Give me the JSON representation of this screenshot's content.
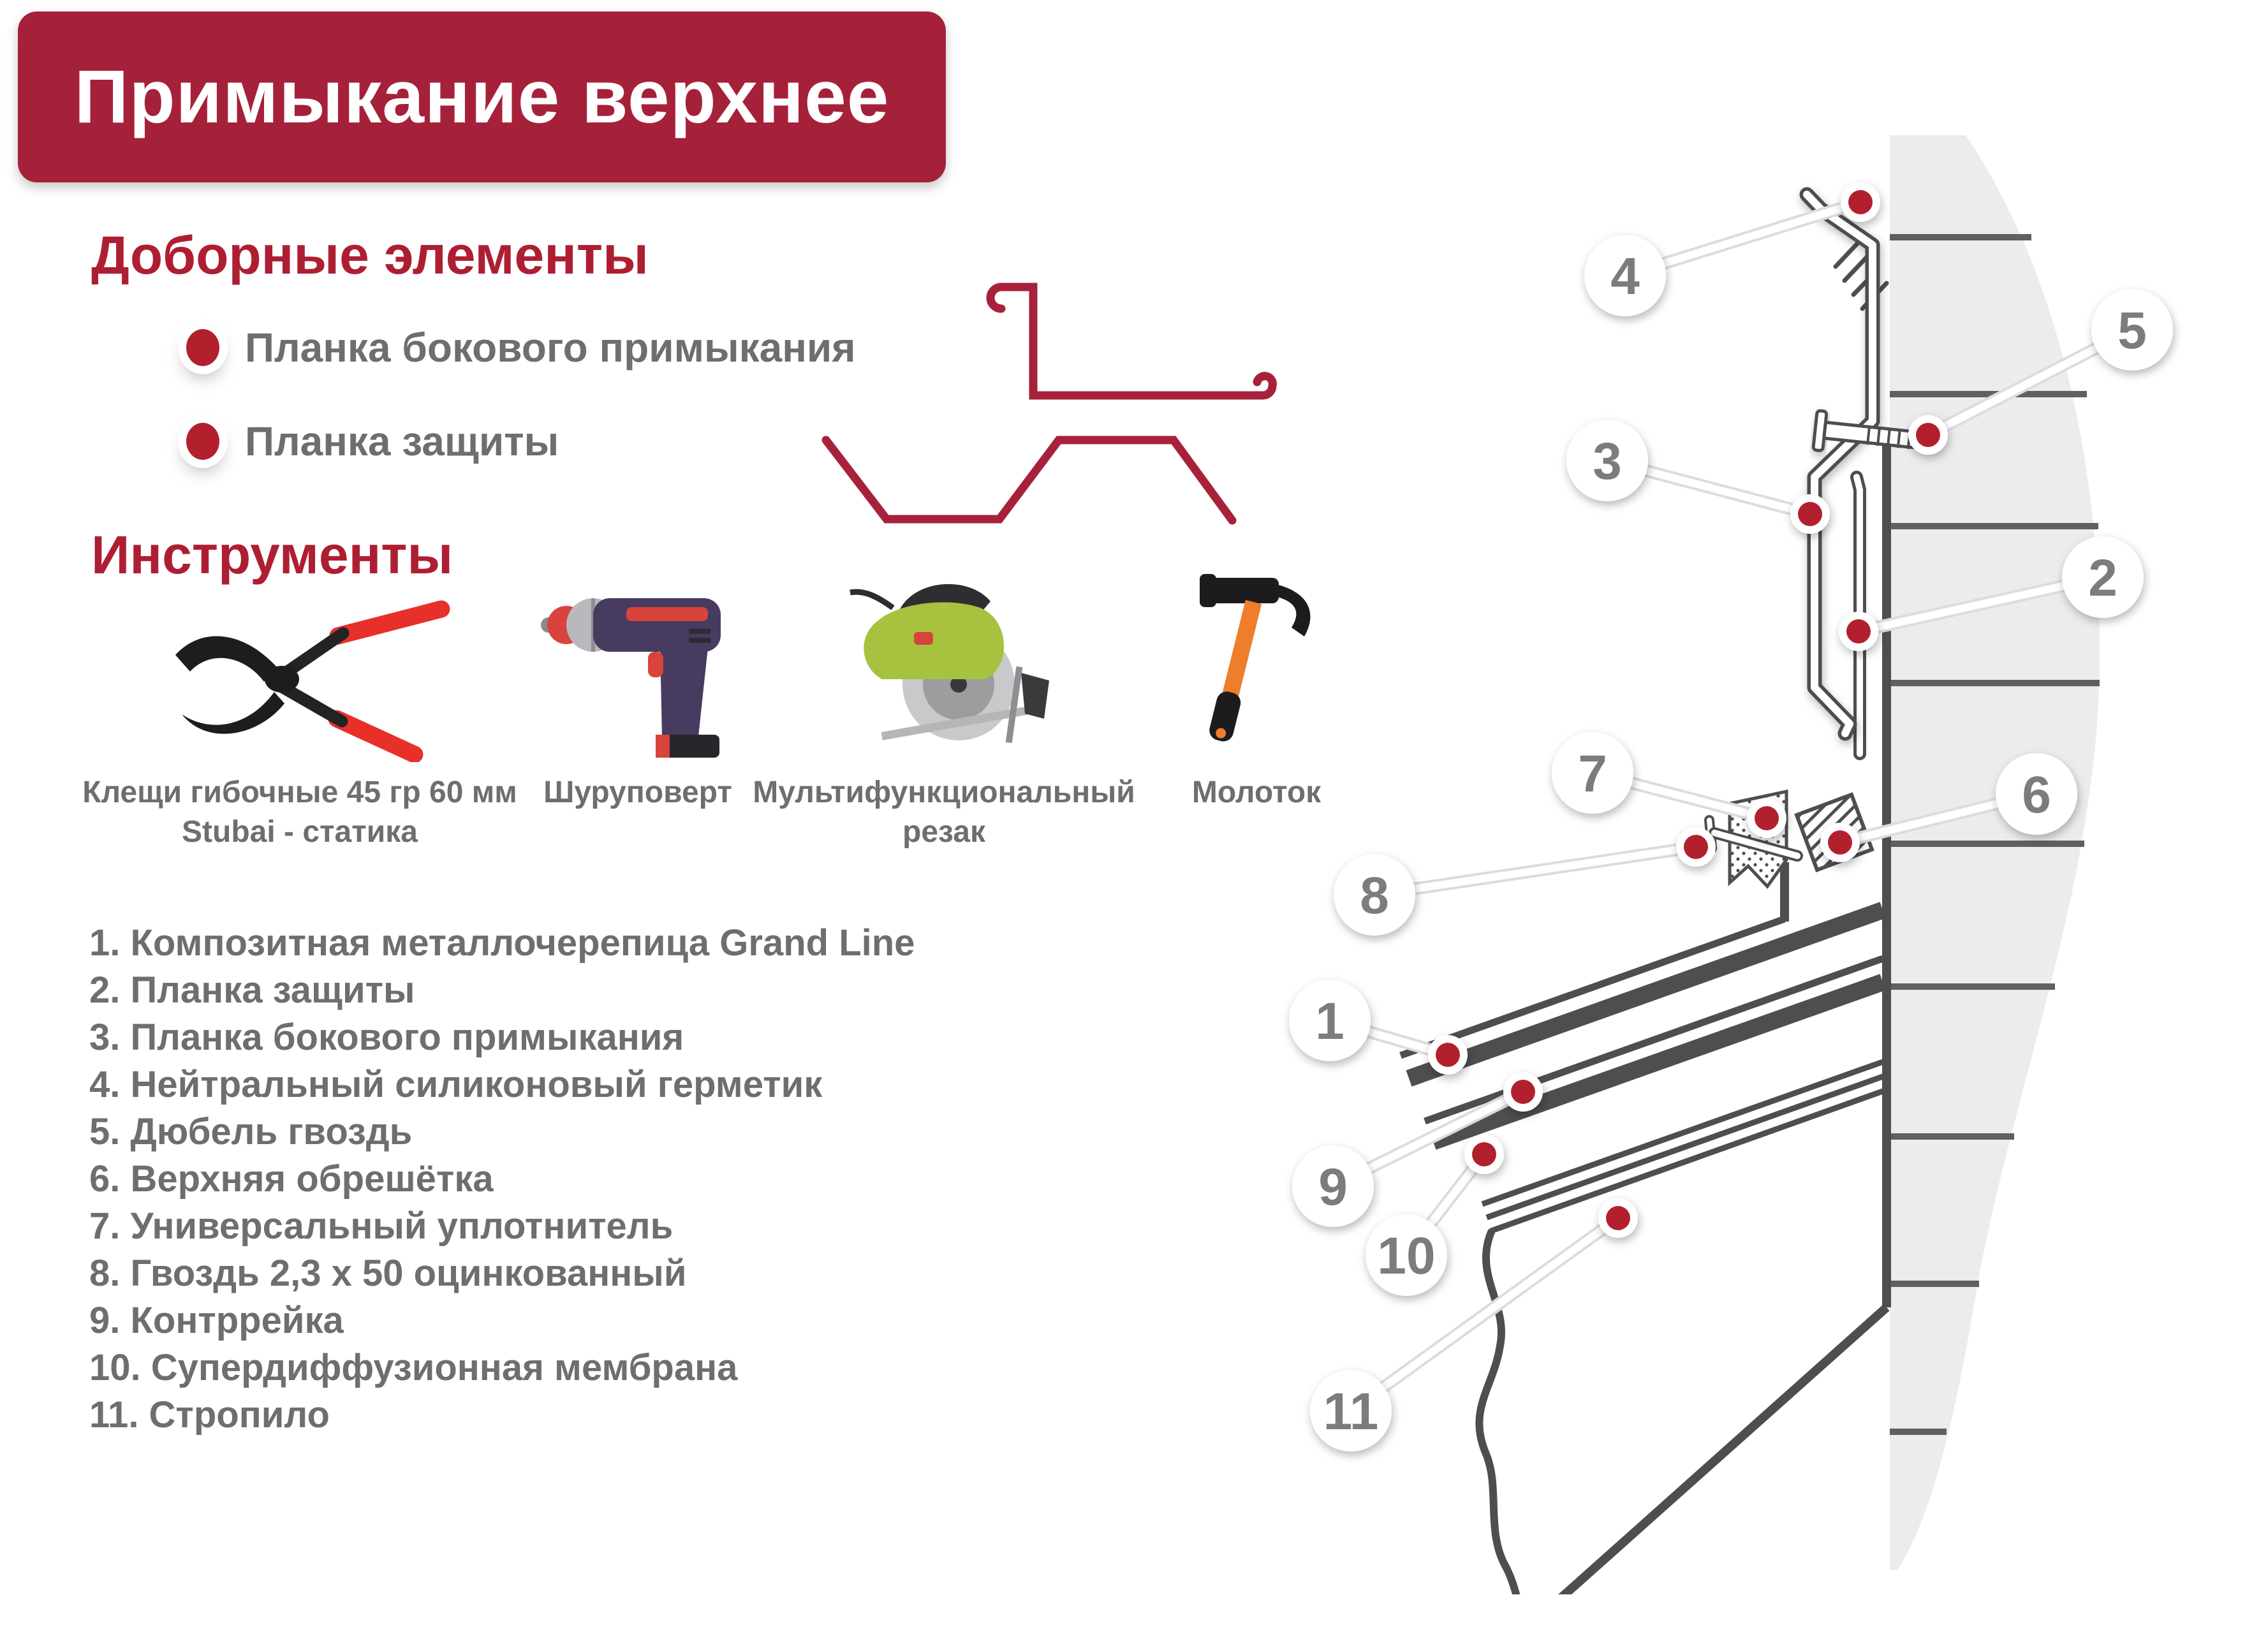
{
  "header": {
    "title": "Примыкание верхнее"
  },
  "elements_section": {
    "title": "Доборные элементы",
    "items": [
      {
        "label": "Планка бокового примыкания"
      },
      {
        "label": "Планка защиты"
      }
    ]
  },
  "tools_section": {
    "title": "Инструменты",
    "tools": [
      {
        "icon": "pliers-icon",
        "label1": "Клещи гибочные 45 гр 60 мм",
        "label2": "Stubai - статика"
      },
      {
        "icon": "drill-icon",
        "label1": "Шуруповерт"
      },
      {
        "icon": "circular-saw-icon",
        "label1": "Мультифункциональный",
        "label2": "резак"
      },
      {
        "icon": "hammer-icon",
        "label1": "Молоток"
      }
    ]
  },
  "legend": {
    "items": [
      "1. Композитная металлочерепица Grand Line",
      "2. Планка защиты",
      "3. Планка бокового примыкания",
      "4. Нейтральный силиконовый герметик",
      "5. Дюбель гвоздь",
      "6. Верхняя обрешётка",
      "7. Универсальный уплотнитель",
      "8. Гвоздь 2,3 х 50 оцинкованный",
      "9. Контррейка",
      "10. Супердиффузионная мембрана",
      "11. Стропило"
    ]
  },
  "diagram": {
    "callouts": [
      "1",
      "2",
      "3",
      "4",
      "5",
      "6",
      "7",
      "8",
      "9",
      "10",
      "11"
    ]
  },
  "colors": {
    "banner_red": "#A5213A",
    "heading_red": "#AE1E32",
    "accent_red": "#B2202E",
    "text_gray": "#6E6E6E",
    "line_dark": "#4E4E50",
    "wall_gray": "#ECECEC"
  }
}
